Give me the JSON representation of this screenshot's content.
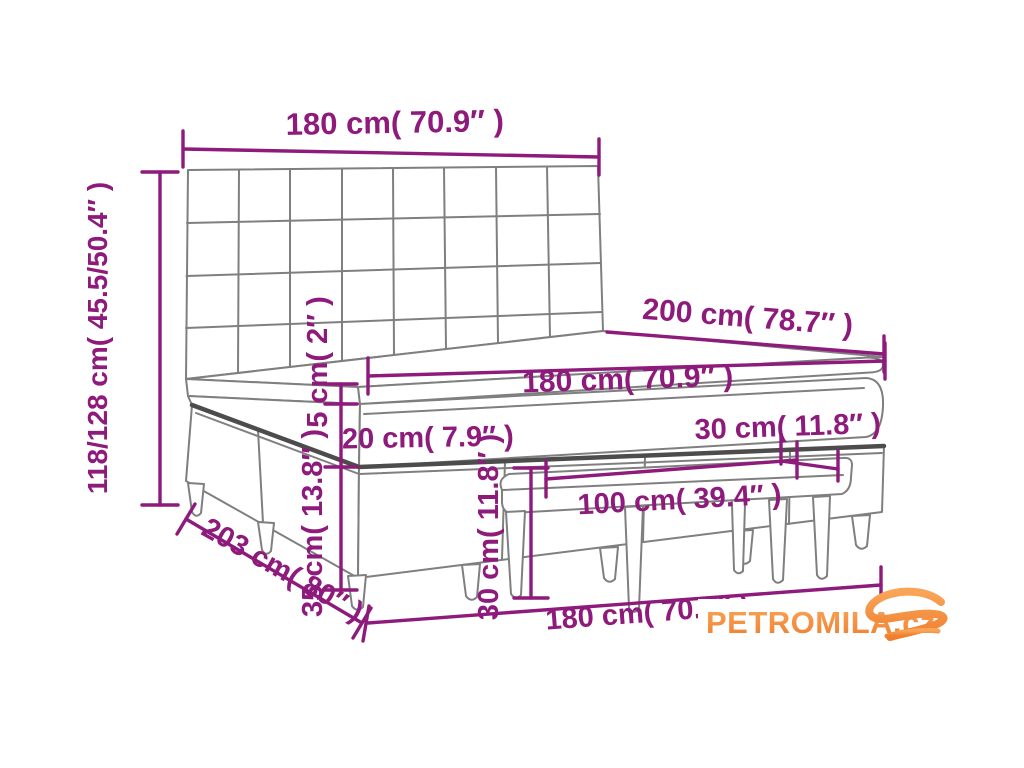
{
  "diagram": {
    "labels": {
      "headboard_width": "180 cm( 70.9″ )",
      "bed_height": "118/128 cm( 45.5/50.4″ )",
      "mattress_length": "200 cm( 78.7″ )",
      "mattress_width": "180 cm( 70.9″ )",
      "topper_thickness": "5 cm( 2″ )",
      "mattress_thickness": "20 cm( 7.9″ )",
      "bench_depth": "30 cm( 11.8″ )",
      "bench_length": "100 cm( 39.4″ )",
      "bench_height": "30 cm( 11.8″ )",
      "base_height": "35 cm( 13.8″ )",
      "frame_length": "203 cm( 80″ )",
      "frame_width": "180 cm( 70.9″ )"
    },
    "watermark": {
      "text": "PETROMILA.cz"
    },
    "colors": {
      "dimension_color": "#8E1A7C",
      "outline_color": "#7F7F7F",
      "outline_bold_color": "#4C4C4C",
      "watermark_orange": "#F6913E"
    }
  }
}
